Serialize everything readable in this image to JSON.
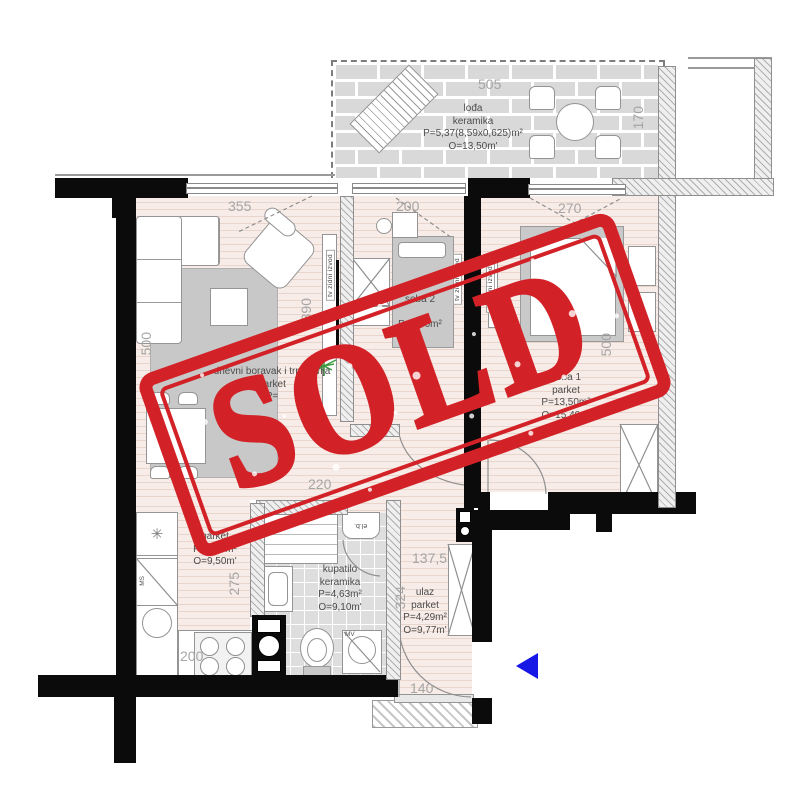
{
  "stamp": {
    "label": "SOLD",
    "color": "#d32227"
  },
  "colors": {
    "stamp_red": "#d32227",
    "wall_black": "#0b0b0b",
    "dim_gray": "#a5a5a5",
    "entry_arrow_blue": "#1717e6",
    "plant_green": "#3f9e3f"
  },
  "icons": {
    "snowflake": "✳",
    "plant": "✳"
  },
  "rooms": {
    "terrace": {
      "name": "lođa",
      "floor": "keramika",
      "area": "P=5,37(8,59x0,625)m²",
      "outline": "O=13,50m'",
      "dim_width": "505",
      "dim_depth": "170"
    },
    "living": {
      "name": "dnevni boravak i trpezarija",
      "floor": "parket",
      "area": "P=",
      "dim_top": "355",
      "dim_right": "390",
      "dim_left": "500",
      "dim_bottom": "220"
    },
    "bedroom2": {
      "name": "soba 2",
      "area": "P=7,60m²",
      "dim_top": "200"
    },
    "bedroom1": {
      "name": "soba 1",
      "floor": "parket",
      "area": "P=13,50m²",
      "outline": "O=15,40m'",
      "dim_top": "270",
      "dim_side": "500"
    },
    "kitchen": {
      "floor": "parket",
      "area": "P=5,50m²",
      "outline": "O=9,50m'",
      "dim_side": "275",
      "dim_bottom": "200",
      "dishwasher_label": "MS"
    },
    "bathroom": {
      "name": "kupatilo",
      "floor": "keramika",
      "area": "P=4,63m²",
      "outline": "O=9,10m'",
      "boiler_label": "el.b.",
      "washer_label": "MV"
    },
    "hall": {
      "name": "ulaz",
      "floor": "parket",
      "area": "P=4,29m²",
      "outline": "O=9,77m'",
      "dim_closet": "137,5",
      "dim_side": "324",
      "dim_door": "140"
    }
  },
  "annotations": {
    "tv_outlet": "tv zidni izvod"
  }
}
